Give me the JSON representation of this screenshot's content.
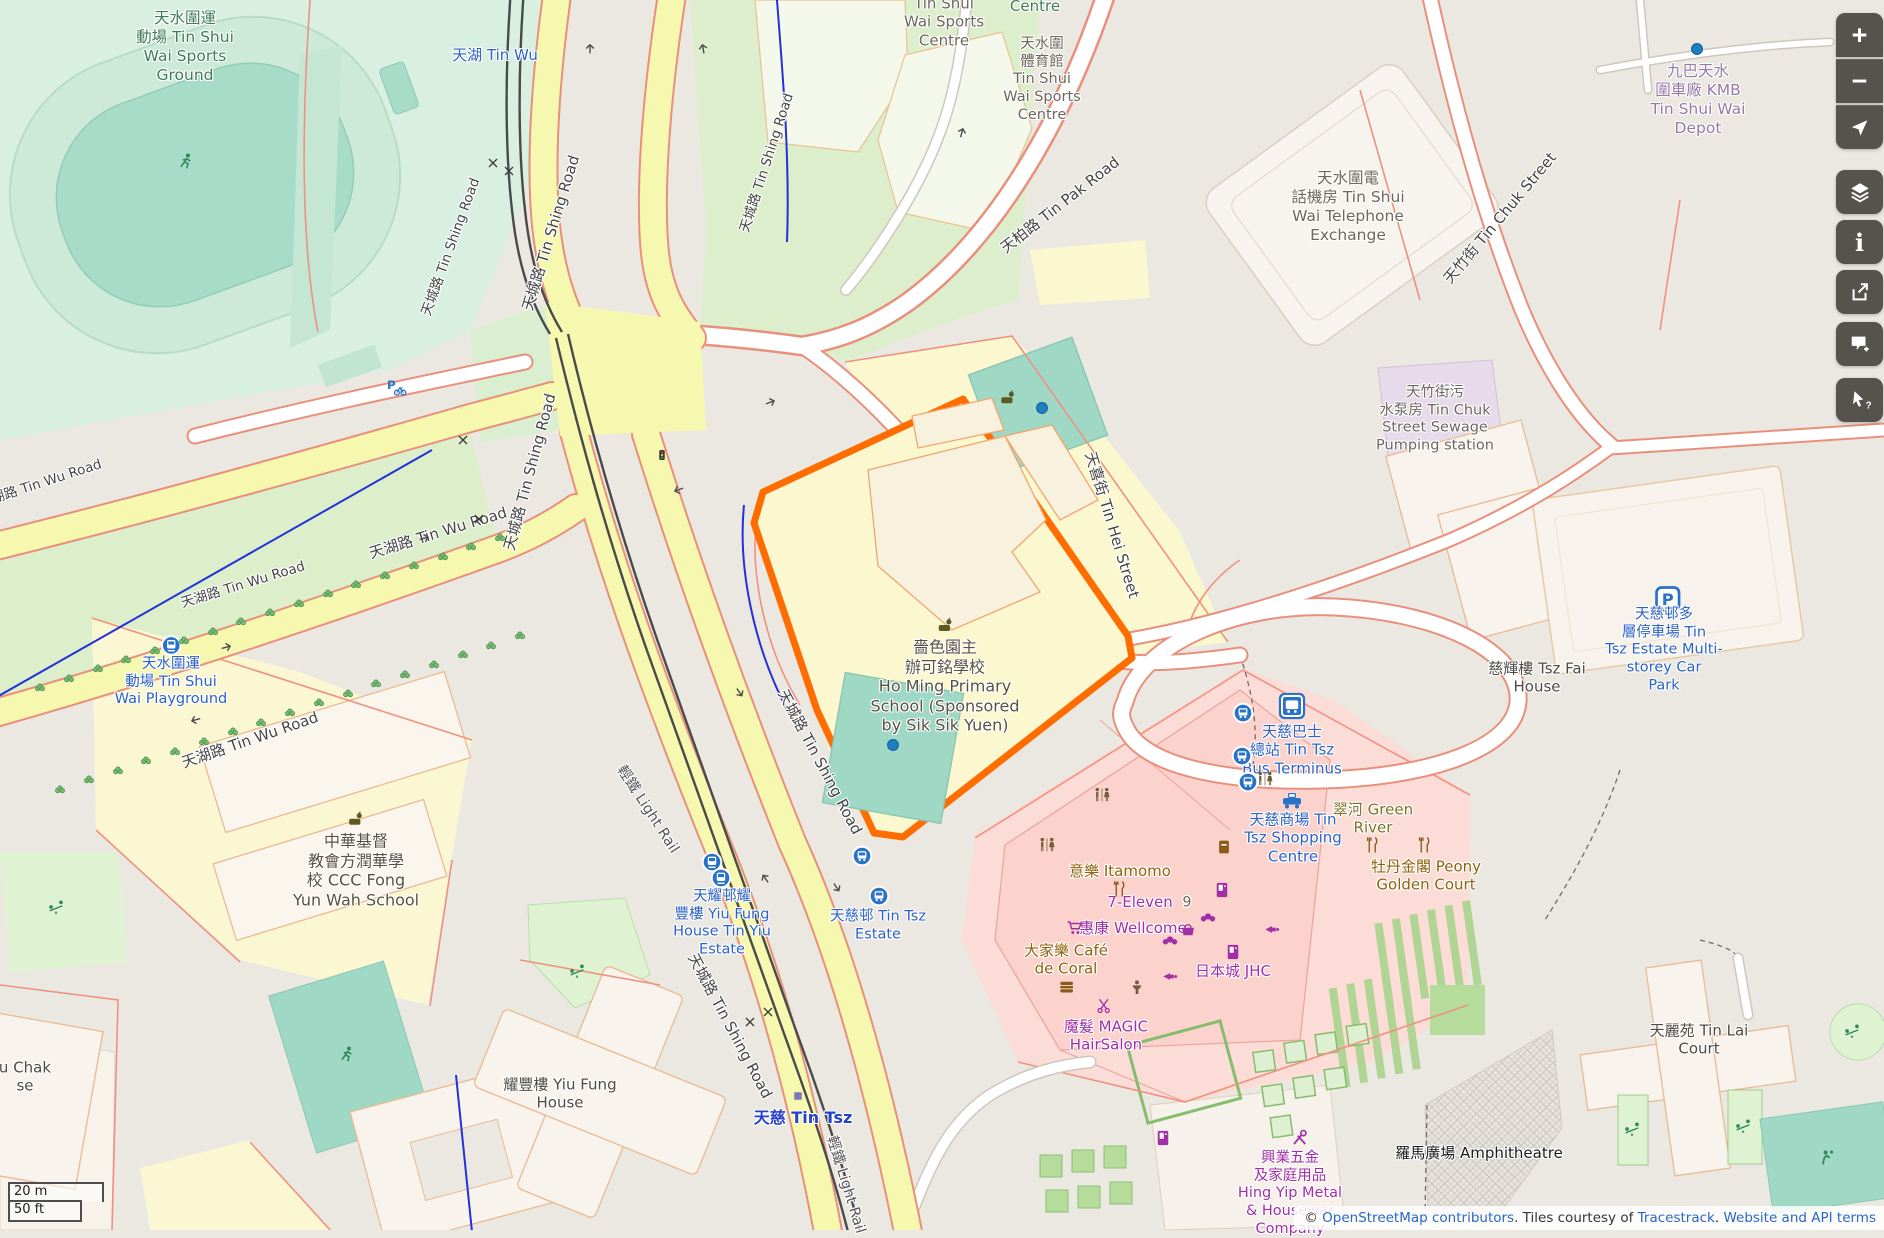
{
  "palette": {
    "highlight_orange": "#ff6c00",
    "road_yellow": "#f6f8b0",
    "road_casing_red": "#e8907c",
    "pitch_teal": "#9fd8c5",
    "retail_pink": "#fcdcd6",
    "school_yellow": "#fbf8d0",
    "transit_blue": "#2d62c6",
    "shop_purple": "#a12fa8",
    "food_brown": "#91610d",
    "control_bg": "#56524c",
    "link_blue": "#2b66c9"
  },
  "map": {
    "labels": [
      {
        "name": "label-tin-shui-wai-sports-ground",
        "cls": "lc-green",
        "x": 185,
        "y": 47,
        "size": 15.5,
        "lines": [
          "天水圍運",
          "動場 Tin Shui",
          "Wai Sports",
          "Ground"
        ]
      },
      {
        "name": "label-sports-centre-clipped",
        "cls": "lc-gray",
        "x": 944,
        "y": 22,
        "size": 15,
        "lines": [
          "Tin Shui",
          "Wai Sports",
          "Centre"
        ]
      },
      {
        "name": "label-centre-clipped",
        "cls": "lc-green",
        "x": 1035,
        "y": 6,
        "size": 15,
        "lines": [
          "Centre"
        ]
      },
      {
        "name": "label-tin-shui-wai-sports-centre",
        "cls": "lc-gray",
        "x": 1042,
        "y": 80,
        "size": 14.5,
        "lines": [
          "天水圍",
          "體育館",
          "Tin Shui",
          "Wai Sports",
          "Centre"
        ]
      },
      {
        "name": "label-telephone-exchange",
        "cls": "lc-gray",
        "x": 1348,
        "y": 207,
        "size": 15.5,
        "lines": [
          "天水圍電",
          "話機房 Tin Shui",
          "Wai Telephone",
          "Exchange"
        ]
      },
      {
        "name": "label-kmb-depot",
        "cls": "lc-mauve",
        "x": 1698,
        "y": 100,
        "size": 15.5,
        "lines": [
          "九巴天水",
          "圍車廠 KMB",
          "Tin Shui Wai",
          "Depot"
        ]
      },
      {
        "name": "label-sewage-pumping-station",
        "cls": "lc-gray",
        "x": 1435,
        "y": 420,
        "size": 14.5,
        "lines": [
          "天竹街污",
          "水泵房 Tin Chuk",
          "Street Sewage",
          "Pumping station"
        ]
      },
      {
        "name": "label-ho-ming-primary-school",
        "cls": "lc-school",
        "x": 945,
        "y": 676,
        "size": 16,
        "icon": "school",
        "lines": [
          "嗇色園主",
          "辦可銘學校",
          "Ho Ming Primary",
          "School (Sponsored",
          "by Sik Sik Yuen)"
        ]
      },
      {
        "name": "label-ccc-fong-yun-wah-school",
        "cls": "lc-school",
        "x": 356,
        "y": 860,
        "size": 16,
        "icon": "school",
        "lines": [
          "中華基督",
          "教會方潤華學",
          "校 CCC Fong",
          "Yun Wah School"
        ]
      },
      {
        "name": "label-tsw-playground-stop",
        "cls": "lc-blue",
        "x": 171,
        "y": 672,
        "size": 14.5,
        "icon": "lr-stop",
        "lines": [
          "天水圍運",
          "動場 Tin Shui",
          "Wai Playground"
        ]
      },
      {
        "name": "label-tin-wu-stop",
        "cls": "lc-blue",
        "x": 495,
        "y": 55,
        "size": 15,
        "lines": [
          "天湖 Tin Wu"
        ]
      },
      {
        "name": "label-yiu-fung-house-tin-yiu-estate",
        "cls": "lc-blue",
        "x": 722,
        "y": 924,
        "size": 14.5,
        "lines": [
          "天耀邨耀",
          "豐樓 Yiu Fung",
          "House Tin Yiu",
          "Estate"
        ]
      },
      {
        "name": "label-tin-tsz-estate",
        "cls": "lc-blue",
        "x": 878,
        "y": 926,
        "size": 14.5,
        "lines": [
          "天慈邨 Tin Tsz",
          "Estate"
        ]
      },
      {
        "name": "label-tin-tsz-bus-terminus",
        "cls": "lc-blue",
        "x": 1292,
        "y": 750,
        "size": 15,
        "lines": [
          "天慈巴士",
          "總站 Tin Tsz",
          "Bus Terminus"
        ]
      },
      {
        "name": "label-tin-tsz-shopping-centre",
        "cls": "lc-blue",
        "x": 1293,
        "y": 838,
        "size": 15,
        "lines": [
          "天慈商場 Tin",
          "Tsz Shopping",
          "Centre"
        ]
      },
      {
        "name": "label-green-river",
        "cls": "lc-olive",
        "x": 1373,
        "y": 819,
        "size": 15,
        "lines": [
          "翠河 Green",
          "River"
        ]
      },
      {
        "name": "label-peony-golden-court",
        "cls": "lc-brown",
        "x": 1426,
        "y": 876,
        "size": 15,
        "lines": [
          "牡丹金閣 Peony",
          "Golden Court"
        ]
      },
      {
        "name": "label-itamomo",
        "cls": "lc-brown",
        "x": 1120,
        "y": 871,
        "size": 15,
        "lines": [
          "意樂 Itamomo"
        ]
      },
      {
        "name": "label-7-eleven",
        "cls": "lc-purple",
        "x": 1140,
        "y": 902,
        "size": 15,
        "lines": [
          "7-Eleven"
        ]
      },
      {
        "name": "label-house-number-9",
        "cls": "lc-gray",
        "x": 1187,
        "y": 903,
        "size": 14,
        "lines": [
          "9"
        ]
      },
      {
        "name": "label-wellcome",
        "cls": "lc-purple",
        "x": 1133,
        "y": 928,
        "size": 15,
        "lines": [
          "惠康 Wellcome"
        ]
      },
      {
        "name": "label-cafe-de-coral",
        "cls": "lc-brown",
        "x": 1066,
        "y": 960,
        "size": 15,
        "lines": [
          "大家樂 Café",
          "de Coral"
        ]
      },
      {
        "name": "label-jhc",
        "cls": "lc-purple",
        "x": 1233,
        "y": 971,
        "size": 15,
        "lines": [
          "日本城 JHC"
        ]
      },
      {
        "name": "label-magic-hairsalon",
        "cls": "lc-purple",
        "x": 1106,
        "y": 1036,
        "size": 15,
        "lines": [
          "魔髮 MAGIC",
          "HairSalon"
        ]
      },
      {
        "name": "label-hing-yip-metal",
        "cls": "lc-purple",
        "x": 1290,
        "y": 1194,
        "size": 14.5,
        "lines": [
          "興業五金",
          "及家庭用品",
          "Hing Yip Metal",
          "& Housewar",
          "Company"
        ]
      },
      {
        "name": "label-amphitheatre",
        "cls": "lc-black",
        "x": 1479,
        "y": 1153,
        "size": 15,
        "lines": [
          "羅馬廣場 Amphitheatre"
        ]
      },
      {
        "name": "label-tin-lai-court",
        "cls": "lc-bldg",
        "x": 1699,
        "y": 1040,
        "size": 15,
        "lines": [
          "天麗苑 Tin Lai",
          "Court"
        ]
      },
      {
        "name": "label-tsz-fai-house",
        "cls": "lc-bldg",
        "x": 1537,
        "y": 678,
        "size": 15,
        "lines": [
          "慈輝樓 Tsz Fai",
          "House"
        ]
      },
      {
        "name": "label-yiu-fung-house",
        "cls": "lc-bldg",
        "x": 560,
        "y": 1094,
        "size": 15,
        "lines": [
          "耀豐樓 Yiu Fung",
          "House"
        ]
      },
      {
        "name": "label-u-chak-clipped",
        "cls": "lc-bldg",
        "x": 25,
        "y": 1077,
        "size": 15,
        "lines": [
          "u Chak",
          "se"
        ]
      },
      {
        "name": "label-tin-tsz-car-park",
        "cls": "lc-blue",
        "x": 1664,
        "y": 640,
        "size": 14.5,
        "icon": "parking",
        "lines": [
          "天慈邨多",
          "層停車場 Tin",
          "Tsz Estate Multi-",
          "storey Car",
          "Park"
        ]
      },
      {
        "name": "label-tin-tsz-station",
        "cls": "lc-station",
        "x": 803,
        "y": 1118,
        "size": 16,
        "lines": [
          "天慈 Tin Tsz"
        ]
      },
      {
        "name": "label-road-tin-shing-a",
        "cls": "lc-road",
        "x": 551,
        "y": 233,
        "rot": -73,
        "size": 15,
        "lines": [
          "天城路 Tin Shing Road"
        ]
      },
      {
        "name": "label-road-tin-shing-b",
        "cls": "lc-road",
        "x": 451,
        "y": 247,
        "rot": -70,
        "size": 13.5,
        "lines": [
          "天城路 Tin Shing Road"
        ]
      },
      {
        "name": "label-road-tin-shing-c",
        "cls": "lc-road",
        "x": 767,
        "y": 163,
        "rot": -72,
        "size": 13.5,
        "lines": [
          "天城路 Tin Shing Road"
        ]
      },
      {
        "name": "label-road-tin-shing-d",
        "cls": "lc-road",
        "x": 530,
        "y": 472,
        "rot": -75,
        "size": 15,
        "lines": [
          "天城路 Tin Shing Road"
        ]
      },
      {
        "name": "label-road-tin-shing-e",
        "cls": "lc-road",
        "x": 820,
        "y": 762,
        "rot": 62,
        "size": 15,
        "lines": [
          "天城路 Tin Shing Road"
        ]
      },
      {
        "name": "label-road-tin-shing-f",
        "cls": "lc-road",
        "x": 730,
        "y": 1026,
        "rot": 62,
        "size": 15,
        "lines": [
          "天城路 Tin Shing Road"
        ]
      },
      {
        "name": "label-road-tin-wu-a",
        "cls": "lc-road",
        "x": 438,
        "y": 533,
        "rot": -17,
        "size": 15,
        "lines": [
          "天湖路 Tin Wu Road"
        ]
      },
      {
        "name": "label-road-tin-wu-b",
        "cls": "lc-road",
        "x": 243,
        "y": 585,
        "rot": -17,
        "size": 13.5,
        "lines": [
          "天湖路 Tin Wu Road"
        ]
      },
      {
        "name": "label-road-tin-wu-c",
        "cls": "lc-road",
        "x": 250,
        "y": 740,
        "rot": -19,
        "size": 15,
        "lines": [
          "天湖路 Tin Wu Road"
        ]
      },
      {
        "name": "label-road-tin-wu-d",
        "cls": "lc-road",
        "x": 40,
        "y": 484,
        "rot": -18,
        "size": 13.5,
        "lines": [
          "天湖路 Tin Wu Road"
        ]
      },
      {
        "name": "label-road-tin-pak",
        "cls": "lc-road",
        "x": 1060,
        "y": 205,
        "rot": -38,
        "size": 15,
        "lines": [
          "天柏路 Tin Pak Road"
        ]
      },
      {
        "name": "label-road-tin-chuk",
        "cls": "lc-road",
        "x": 1500,
        "y": 218,
        "rot": -50,
        "size": 15,
        "lines": [
          "天竹街 Tin Chuk Street"
        ]
      },
      {
        "name": "label-road-tin-hei",
        "cls": "lc-road",
        "x": 1112,
        "y": 525,
        "rot": 73,
        "size": 15,
        "lines": [
          "天喜街 Tin Hei Street"
        ]
      },
      {
        "name": "label-light-rail-a",
        "cls": "lc-rail",
        "x": 647,
        "y": 810,
        "rot": 57,
        "size": 14.5,
        "lines": [
          "輕鐵 Light Rail"
        ]
      },
      {
        "name": "label-light-rail-b",
        "cls": "lc-rail",
        "x": 845,
        "y": 1185,
        "rot": 73,
        "size": 14.5,
        "lines": [
          "輕鐵 Light Rail"
        ]
      }
    ],
    "markers": [
      {
        "type": "bus-stop",
        "x": 1243,
        "y": 713
      },
      {
        "type": "bus-stop",
        "x": 1242,
        "y": 756
      },
      {
        "type": "bus-stop",
        "x": 1248,
        "y": 782
      },
      {
        "type": "bus-stop",
        "x": 862,
        "y": 856
      },
      {
        "type": "bus-stop",
        "x": 879,
        "y": 896
      },
      {
        "type": "lr-stop",
        "x": 712,
        "y": 862
      },
      {
        "type": "lr-stop",
        "x": 721,
        "y": 878
      },
      {
        "type": "bus-station",
        "x": 1292,
        "y": 706
      },
      {
        "type": "taxi",
        "x": 1292,
        "y": 801
      },
      {
        "type": "parking-bike",
        "x": 396,
        "y": 388
      },
      {
        "type": "toilets",
        "x": 1102,
        "y": 796
      },
      {
        "type": "toilets",
        "x": 1047,
        "y": 846
      },
      {
        "type": "toilets",
        "x": 1265,
        "y": 780
      },
      {
        "type": "restaurant",
        "x": 1120,
        "y": 889
      },
      {
        "type": "restaurant",
        "x": 1373,
        "y": 845
      },
      {
        "type": "restaurant",
        "x": 1425,
        "y": 845
      },
      {
        "type": "postbox",
        "x": 1224,
        "y": 847
      },
      {
        "type": "vending",
        "x": 1222,
        "y": 890
      },
      {
        "type": "vending",
        "x": 1163,
        "y": 1138
      },
      {
        "type": "vending",
        "x": 1233,
        "y": 952
      },
      {
        "type": "burger",
        "x": 1067,
        "y": 987
      },
      {
        "type": "person",
        "x": 1137,
        "y": 988
      },
      {
        "type": "horn",
        "x": 1170,
        "y": 978
      },
      {
        "type": "horn",
        "x": 1272,
        "y": 931
      },
      {
        "type": "scissors",
        "x": 1105,
        "y": 1006
      },
      {
        "type": "cart",
        "x": 1075,
        "y": 928
      },
      {
        "type": "basket",
        "x": 1188,
        "y": 930
      },
      {
        "type": "bakery",
        "x": 1208,
        "y": 918
      },
      {
        "type": "bakery",
        "x": 1170,
        "y": 941
      },
      {
        "type": "hardware",
        "x": 1300,
        "y": 1138
      },
      {
        "type": "seesaw",
        "x": 56,
        "y": 908
      },
      {
        "type": "seesaw",
        "x": 577,
        "y": 972
      },
      {
        "type": "seesaw",
        "x": 1632,
        "y": 1130
      },
      {
        "type": "seesaw",
        "x": 1743,
        "y": 1127
      },
      {
        "type": "seesaw",
        "x": 1852,
        "y": 1032
      },
      {
        "type": "runner",
        "x": 186,
        "y": 162
      },
      {
        "type": "runner",
        "x": 347,
        "y": 1055
      },
      {
        "type": "volley",
        "x": 1828,
        "y": 1158
      },
      {
        "type": "school",
        "x": 1008,
        "y": 398
      },
      {
        "type": "node-dot",
        "x": 1697,
        "y": 49
      },
      {
        "type": "node-dot",
        "x": 1042,
        "y": 408
      },
      {
        "type": "node-dot",
        "x": 893,
        "y": 745
      },
      {
        "type": "lr-platform",
        "x": 798,
        "y": 1096
      },
      {
        "type": "crossing-x",
        "x": 493,
        "y": 163
      },
      {
        "type": "crossing-x",
        "x": 509,
        "y": 171
      },
      {
        "type": "crossing-x",
        "x": 463,
        "y": 440
      },
      {
        "type": "crossing-x",
        "x": 479,
        "y": 519
      },
      {
        "type": "crossing-x",
        "x": 750,
        "y": 1022
      },
      {
        "type": "crossing-x",
        "x": 768,
        "y": 1012
      },
      {
        "type": "traffic-light",
        "x": 662,
        "y": 455
      },
      {
        "type": "oneway-arrow",
        "x": 590,
        "y": 48,
        "rot": -90
      },
      {
        "type": "oneway-arrow",
        "x": 703,
        "y": 48,
        "rot": -100
      },
      {
        "type": "oneway-arrow",
        "x": 962,
        "y": 132,
        "rot": -75
      },
      {
        "type": "oneway-arrow",
        "x": 227,
        "y": 647,
        "rot": -15
      },
      {
        "type": "oneway-arrow",
        "x": 195,
        "y": 720,
        "rot": 165
      },
      {
        "type": "oneway-arrow",
        "x": 740,
        "y": 693,
        "rot": 55
      },
      {
        "type": "oneway-arrow",
        "x": 765,
        "y": 878,
        "rot": -125
      },
      {
        "type": "oneway-arrow",
        "x": 837,
        "y": 888,
        "rot": 55
      },
      {
        "type": "oneway-arrow",
        "x": 425,
        "y": 538,
        "rot": -15
      },
      {
        "type": "oneway-arrow",
        "x": 678,
        "y": 490,
        "rot": 160
      },
      {
        "type": "oneway-arrow",
        "x": 771,
        "y": 402,
        "rot": -20
      }
    ]
  },
  "controls": [
    {
      "name": "zoom-in-button",
      "icon": "zoom-in",
      "glyph": "+"
    },
    {
      "name": "zoom-out-button",
      "icon": "zoom-out",
      "glyph": "−"
    },
    {
      "name": "locate-button",
      "icon": "locate"
    },
    {
      "name": "layers-button",
      "icon": "layers"
    },
    {
      "name": "info-button",
      "icon": "info",
      "glyph": "i"
    },
    {
      "name": "share-button",
      "icon": "share"
    },
    {
      "name": "add-note-button",
      "icon": "add-note"
    },
    {
      "name": "query-features-button",
      "icon": "query-features"
    }
  ],
  "scalebar": {
    "metric": "20 m",
    "imperial": "50 ft"
  },
  "attribution": {
    "copyright": "© ",
    "link_osm": "OpenStreetMap contributors",
    "middle": ". Tiles courtesy of ",
    "link_tracestrack": "Tracestrack",
    "sep": ". ",
    "link_terms": "Website and API terms"
  }
}
